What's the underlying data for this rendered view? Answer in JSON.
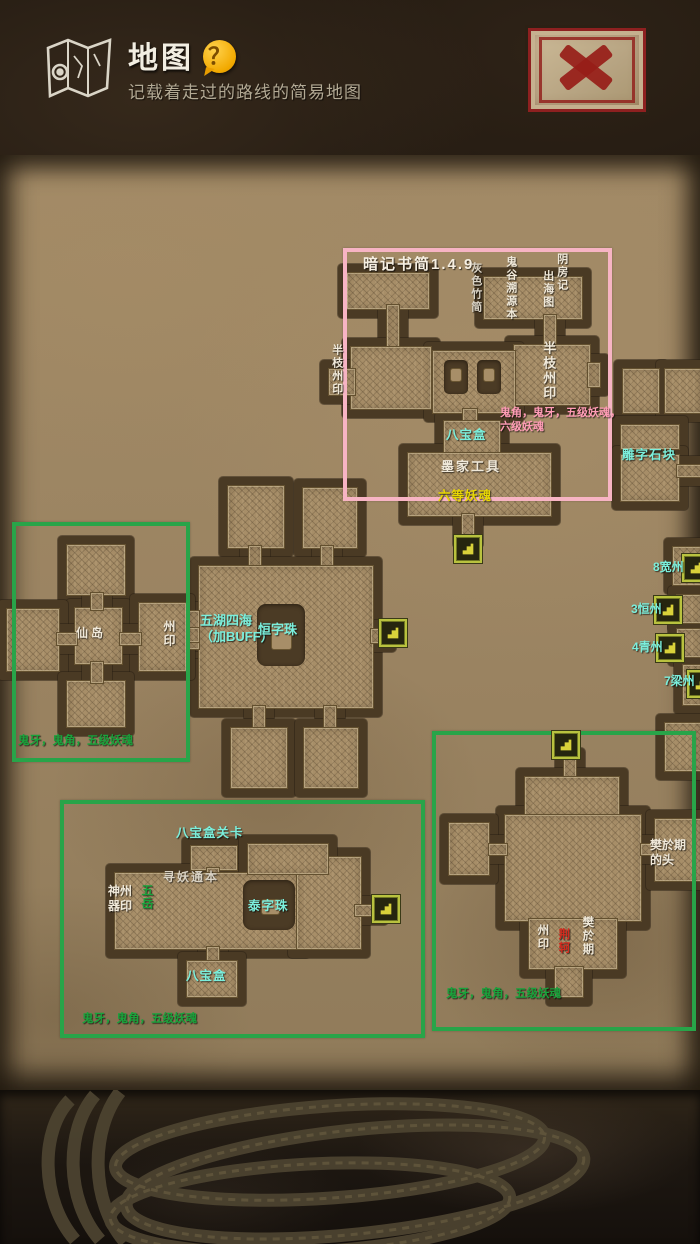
{
  "header": {
    "title": "地图",
    "subtitle": "记载着走过的路线的简易地图",
    "help_glyph": "？"
  },
  "close_button": {
    "icon_name": "x-icon"
  },
  "icons": {
    "header_icon": "map-icon",
    "help_icon": "question-bubble-icon",
    "close_icon": "x-icon",
    "map_marker_icon": "stairs-exit-icon",
    "map_marker_count": 8
  },
  "palette": {
    "parchment": "#9c8766",
    "room_fill": "#a78e68",
    "moat": "#4a3a24",
    "pink_box": "#f7b4c4",
    "green_box": "#28a449",
    "cyan_text": "#7befdc",
    "white_text": "#f0e9da",
    "yellow_text": "#e8d704",
    "pink_text": "#ff9cb6",
    "green_text": "#19a23b",
    "red_text": "#d42a1e",
    "marker_border": "#b9c23f"
  },
  "map": {
    "annotation_boxes": [
      {
        "id": "pink-box",
        "color": "#f7b4c4"
      },
      {
        "id": "green-box-left",
        "color": "#28a449"
      },
      {
        "id": "green-box-bottom-left",
        "color": "#28a449"
      },
      {
        "id": "green-box-bottom-right",
        "color": "#28a449"
      }
    ],
    "labels": [
      {
        "id": "pink-box-title",
        "text": "暗记书简1.4.9",
        "color": "#f6efe2"
      },
      {
        "id": "gray-bamboo-slip",
        "text": "灰色竹简",
        "color": "#d9d2c4"
      },
      {
        "id": "guigu-source-book",
        "text": "鬼谷溯源本",
        "color": "#f0e9da"
      },
      {
        "id": "yin-house-record",
        "text": "阴房记",
        "color": "#f0e9da"
      },
      {
        "id": "sea-chart",
        "text": "出海图",
        "color": "#f0e9da"
      },
      {
        "id": "half-branch-seal-left",
        "text": "半枝州印",
        "color": "#f0e9da"
      },
      {
        "id": "half-branch-seal-right",
        "text": "半枝州印",
        "color": "#f0e9da"
      },
      {
        "id": "pink-drop-note",
        "text": "鬼角，鬼牙，五级妖魂，六级妖魂",
        "color": "#ff9cb6"
      },
      {
        "id": "treasure-box-room",
        "text": "八宝盒",
        "color": "#7befdc"
      },
      {
        "id": "mohist-tools",
        "text": "墨家工具",
        "color": "#f0e9da"
      },
      {
        "id": "grade-6-soul",
        "text": "六等妖魂",
        "color": "#e8d704"
      },
      {
        "id": "carved-stone-block",
        "text": "雕字石块",
        "color": "#7befdc"
      },
      {
        "id": "state-8-kuan",
        "text": "8宽州",
        "color": "#7befdc"
      },
      {
        "id": "state-3-heng",
        "text": "3恒州",
        "color": "#7befdc"
      },
      {
        "id": "state-4-qing",
        "text": "4青州",
        "color": "#7befdc"
      },
      {
        "id": "state-7-liang",
        "text": "7梁州",
        "color": "#7befdc"
      },
      {
        "id": "immortal-island",
        "text": "仙岛",
        "color": "#f0e9da"
      },
      {
        "id": "state-seal-left",
        "text": "州印",
        "color": "#f0e9da"
      },
      {
        "id": "drops-left",
        "text": "鬼牙，鬼角，五级妖魂",
        "color": "#19a23b"
      },
      {
        "id": "five-lakes-buff",
        "text": "五湖四海\n（加BUFF）",
        "color": "#7befdc"
      },
      {
        "id": "heng-pearl",
        "text": "恒字珠",
        "color": "#7befdc"
      },
      {
        "id": "treasure-box-checkpoint",
        "text": "八宝盒关卡",
        "color": "#7befdc"
      },
      {
        "id": "seek-demon-book",
        "text": "寻妖通本",
        "color": "#d9d2c4"
      },
      {
        "id": "shenzhou-seal",
        "text": "神州\n器印",
        "color": "#f0e9da"
      },
      {
        "id": "five-peaks",
        "text": "五岳",
        "color": "#19a23b"
      },
      {
        "id": "tai-pearl",
        "text": "泰字珠",
        "color": "#7befdc"
      },
      {
        "id": "treasure-box-2",
        "text": "八宝盒",
        "color": "#7befdc"
      },
      {
        "id": "drops-bottom-left",
        "text": "鬼牙，鬼角，五级妖魂",
        "color": "#19a23b"
      },
      {
        "id": "fan-wuji-head",
        "text": "樊於期\n的头",
        "color": "#f0e9da"
      },
      {
        "id": "state-seal-bottom-right",
        "text": "州印",
        "color": "#f0e9da"
      },
      {
        "id": "jing-ke",
        "text": "荆轲",
        "color": "#d42a1e"
      },
      {
        "id": "fan-wuji",
        "text": "樊於期",
        "color": "#f0e9da"
      },
      {
        "id": "drops-bottom-right",
        "text": "鬼牙，鬼角，五级妖魂",
        "color": "#19a23b"
      }
    ]
  }
}
